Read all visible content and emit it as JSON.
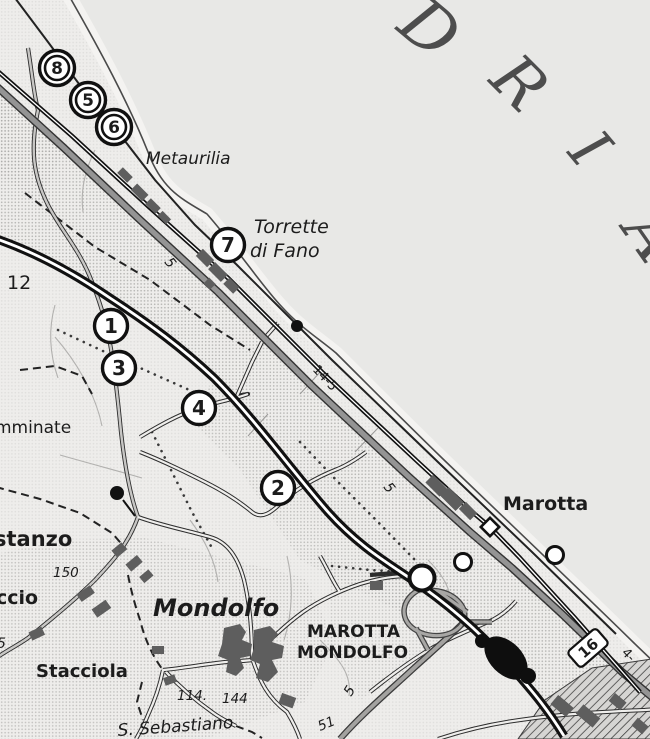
{
  "canvas": {
    "width": 650,
    "height": 739
  },
  "colors": {
    "paper": "#eeedeb",
    "sea": "#e8e8e6",
    "beach": "#f4f3f1",
    "road_gray": "#949494",
    "minor_road_fill": "#efeeec",
    "builtup": "#5e5e5e",
    "ink": "#141414",
    "halftone": "#8e8e8c",
    "sea_text": "#4d4d4d"
  },
  "sea_letters": [
    {
      "ch": "D",
      "x": 415,
      "y": 46,
      "rot": 40,
      "size": 66
    },
    {
      "ch": "R",
      "x": 504,
      "y": 98,
      "rot": 45,
      "size": 63
    },
    {
      "ch": "I",
      "x": 574,
      "y": 162,
      "rot": 50,
      "size": 60
    },
    {
      "ch": "A",
      "x": 634,
      "y": 248,
      "rot": 55,
      "size": 63
    }
  ],
  "place_labels": [
    {
      "id": "metaurilia",
      "text": "Metaurilia",
      "x": 146,
      "y": 164,
      "size": 17,
      "style": "italic",
      "rot": 0
    },
    {
      "id": "torrette-line1",
      "text": "Torrette",
      "x": 254,
      "y": 233,
      "size": 19,
      "style": "italic",
      "rot": 0
    },
    {
      "id": "torrette-line2",
      "text": "di Fano",
      "x": 250,
      "y": 257,
      "size": 19,
      "style": "italic",
      "rot": 0
    },
    {
      "id": "marotta",
      "text": "Marotta",
      "x": 503,
      "y": 510,
      "size": 19,
      "style": "bold",
      "rot": 0
    },
    {
      "id": "exit-line1",
      "text": "MAROTTA",
      "x": 307,
      "y": 637,
      "size": 17,
      "style": "bold",
      "rot": 0
    },
    {
      "id": "exit-line2",
      "text": "MONDOLFO",
      "x": 297,
      "y": 658,
      "size": 17,
      "style": "bold",
      "rot": 0
    },
    {
      "id": "mondolfo",
      "text": "Mondolfo",
      "x": 153,
      "y": 616,
      "size": 24,
      "style": "bolditalic",
      "rot": 0
    },
    {
      "id": "stacciola",
      "text": "Stacciola",
      "x": 36,
      "y": 677,
      "size": 18,
      "style": "bold",
      "rot": 0
    },
    {
      "id": "costanzo-part",
      "text": "stanzo",
      "x": -6,
      "y": 546,
      "size": 21,
      "style": "bold",
      "rot": 0
    },
    {
      "id": "ccio-part",
      "text": "ccio",
      "x": -4,
      "y": 604,
      "size": 19,
      "style": "bold",
      "rot": 0
    },
    {
      "id": "mminate-part",
      "text": "mminate",
      "x": -5,
      "y": 433,
      "size": 17,
      "style": "normal",
      "rot": 0
    },
    {
      "id": "s-sebastiano",
      "text": "S. Sebastiano",
      "x": 118,
      "y": 736,
      "size": 17,
      "style": "italic",
      "rot": -4
    },
    {
      "id": "h12",
      "text": "12",
      "x": 7,
      "y": 289,
      "size": 19,
      "style": "normal",
      "rot": 0
    },
    {
      "id": "h150",
      "text": "150",
      "x": 53,
      "y": 577,
      "size": 13.5,
      "style": "italic",
      "rot": 0
    },
    {
      "id": "h114",
      "text": "114.",
      "x": 177,
      "y": 700,
      "size": 13.5,
      "style": "italic",
      "rot": 0
    },
    {
      "id": "h144",
      "text": "144",
      "x": 222,
      "y": 703,
      "size": 13.5,
      "style": "italic",
      "rot": 0
    },
    {
      "id": "d51",
      "text": "51",
      "x": 320,
      "y": 731,
      "size": 13.5,
      "style": "italic",
      "rot": -22
    },
    {
      "id": "d5-a",
      "text": "5",
      "x": 164,
      "y": 262,
      "size": 14,
      "style": "italic",
      "rot": 52
    },
    {
      "id": "d5-b",
      "text": "5",
      "x": 383,
      "y": 487,
      "size": 14,
      "style": "italic",
      "rot": 52
    },
    {
      "id": "d5-c",
      "text": "5",
      "x": 351,
      "y": 697,
      "size": 14,
      "style": "italic",
      "rot": -58
    },
    {
      "id": "d5-d",
      "text": "5",
      "x": -3,
      "y": 648,
      "size": 14,
      "style": "italic",
      "rot": 0
    },
    {
      "id": "km14-5",
      "text": "14-5",
      "x": 312,
      "y": 370,
      "size": 13,
      "style": "normal",
      "rot": 47
    },
    {
      "id": "km4-part",
      "text": "4-",
      "x": 621,
      "y": 653,
      "size": 13,
      "style": "normal",
      "rot": 47
    }
  ],
  "route_shield": {
    "number": "16",
    "x": 588,
    "y": 648,
    "rot": -41,
    "w": 38,
    "h": 21
  },
  "itinerary_markers": [
    {
      "number": "8",
      "x": 57,
      "y": 68,
      "double": true
    },
    {
      "number": "5",
      "x": 88,
      "y": 100,
      "double": true
    },
    {
      "number": "6",
      "x": 114,
      "y": 127,
      "double": true
    },
    {
      "number": "7",
      "x": 228,
      "y": 245,
      "double": false
    },
    {
      "number": "1",
      "x": 111,
      "y": 326,
      "double": false
    },
    {
      "number": "3",
      "x": 119,
      "y": 368,
      "double": false
    },
    {
      "number": "4",
      "x": 199,
      "y": 408,
      "double": false
    },
    {
      "number": "2",
      "x": 278,
      "y": 488,
      "double": false
    }
  ],
  "station_diamond": {
    "x": 490,
    "y": 527,
    "size": 13
  },
  "toll_circles": [
    {
      "x": 422,
      "y": 578,
      "r": 12.5,
      "sw": 4
    },
    {
      "x": 463,
      "y": 562,
      "r": 8.5,
      "sw": 3
    },
    {
      "x": 555,
      "y": 555,
      "r": 8.5,
      "sw": 3
    }
  ],
  "spot_dots": [
    {
      "x": 297,
      "y": 326,
      "r": 6,
      "stem": null
    },
    {
      "x": 117,
      "y": 493,
      "r": 7,
      "stem": [
        123,
        500,
        135,
        516
      ]
    }
  ]
}
